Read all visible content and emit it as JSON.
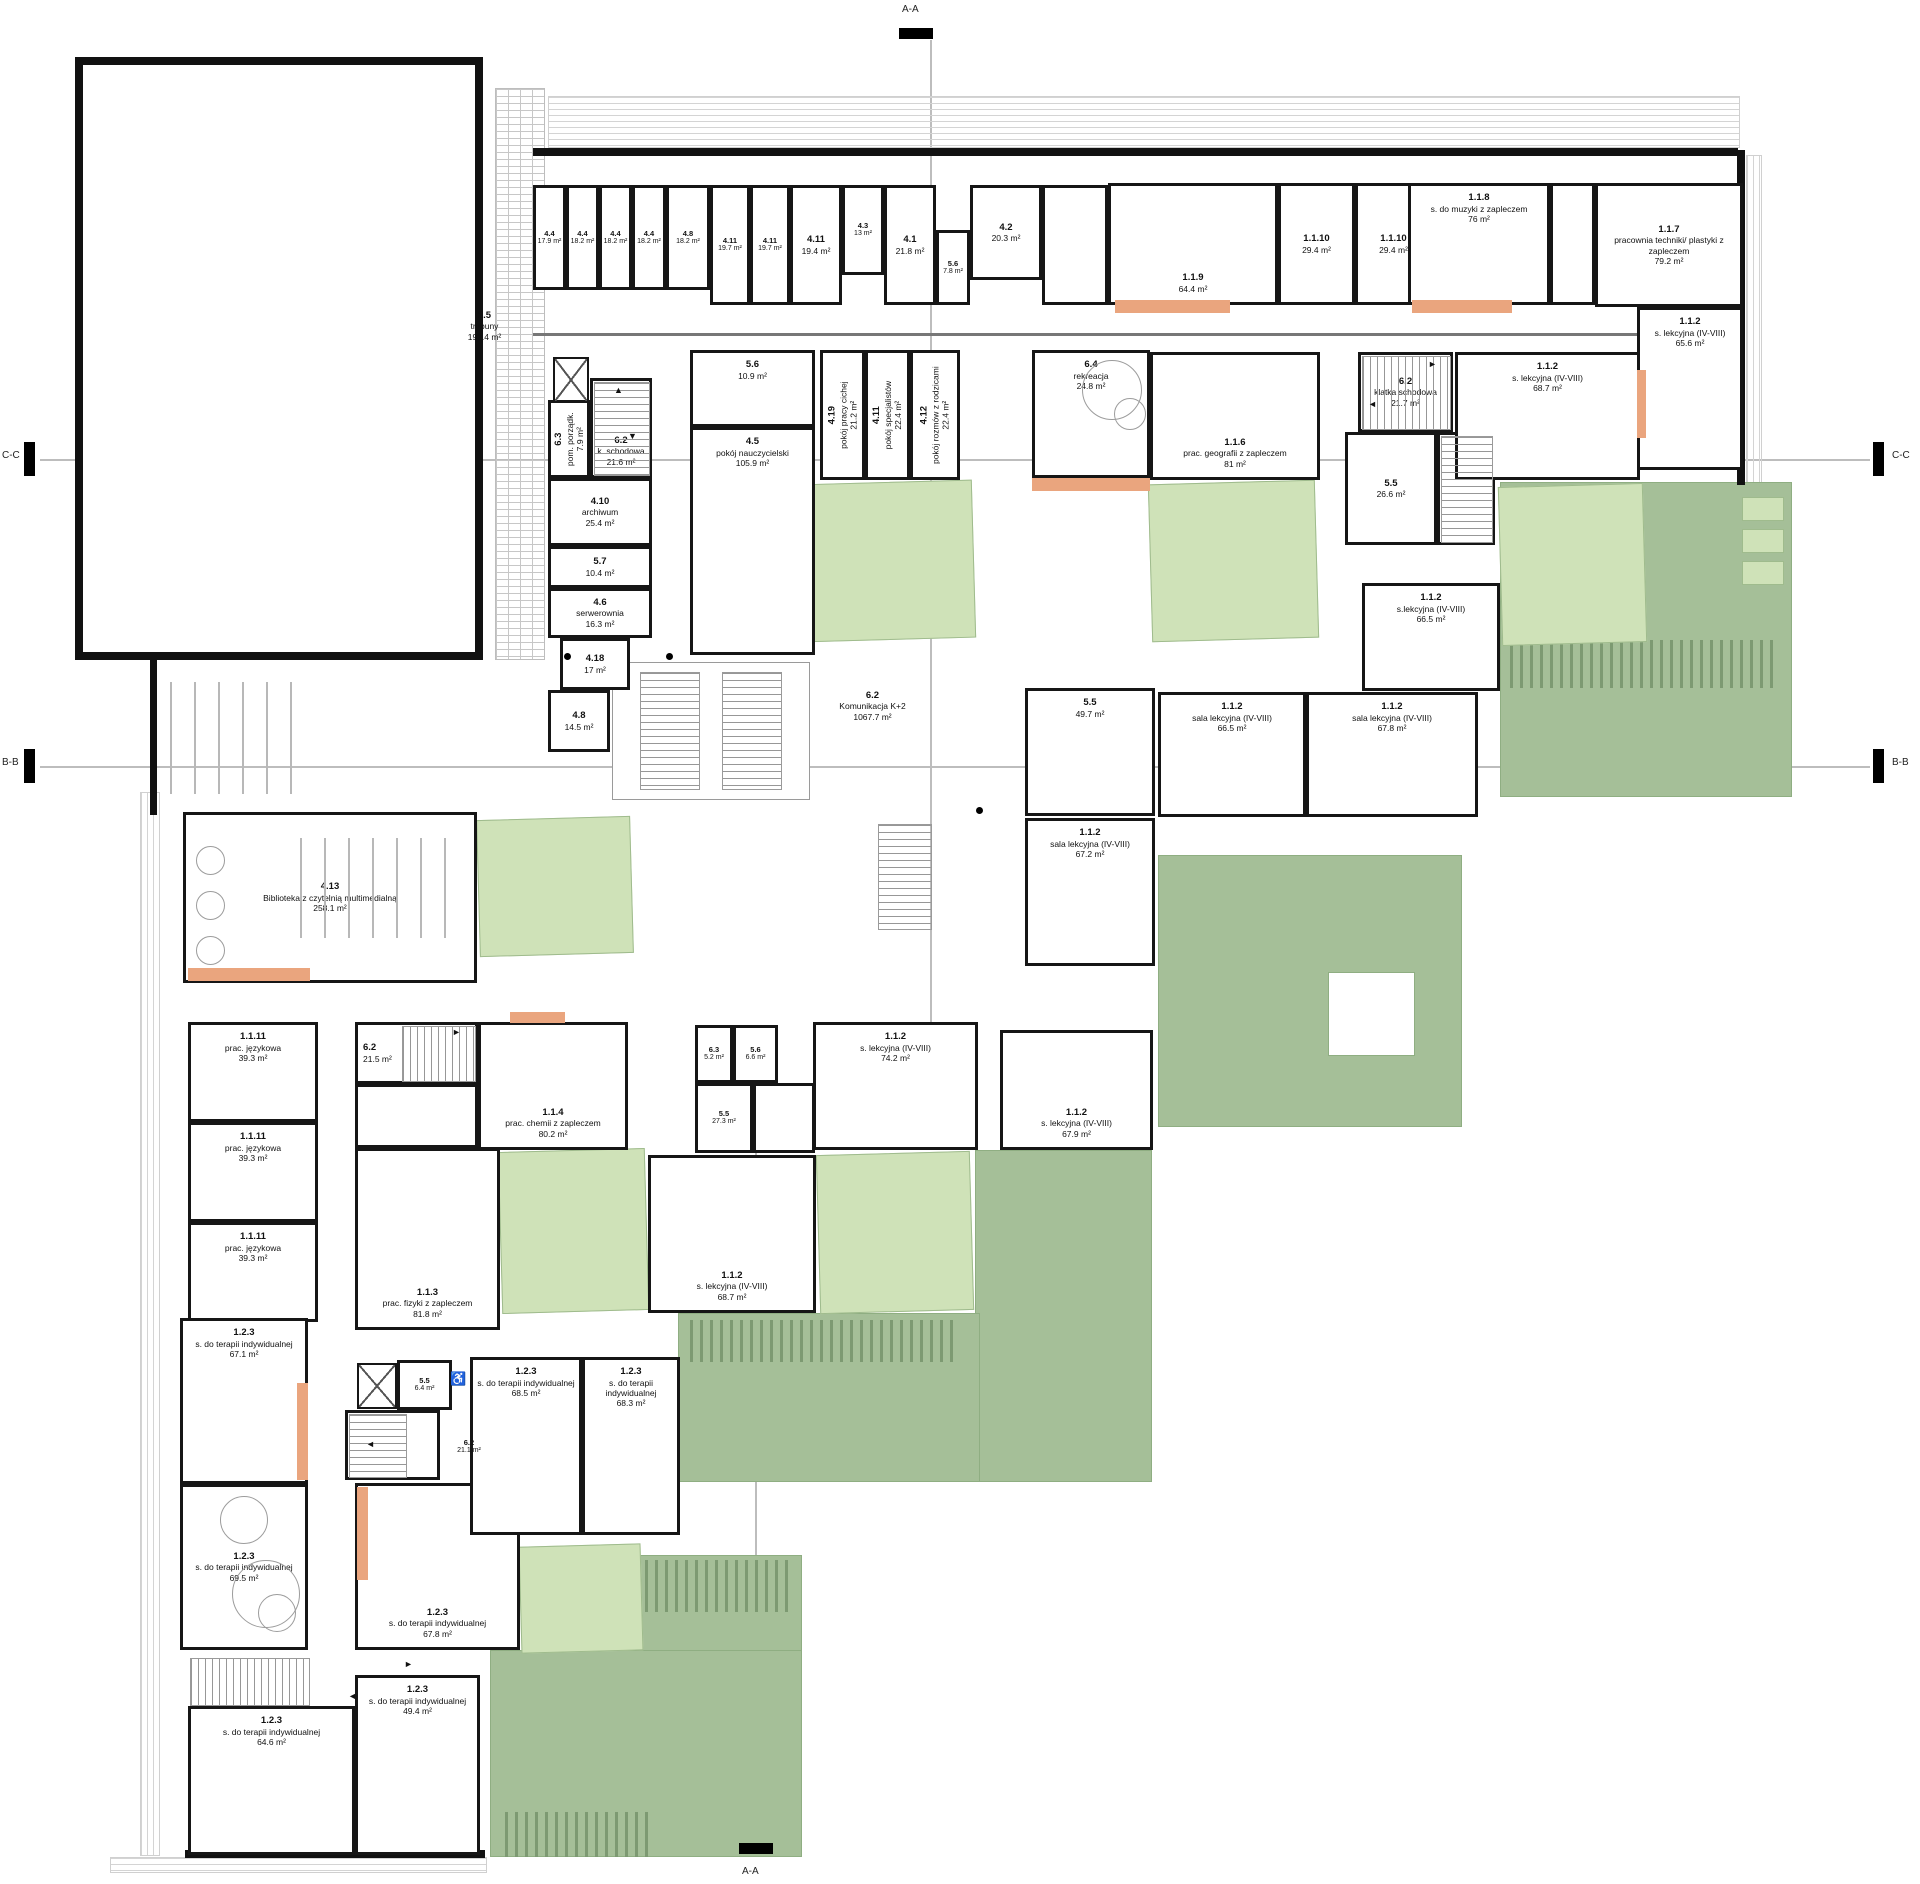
{
  "plan": {
    "width": 1920,
    "height": 1884,
    "colors": {
      "wall": "#161616",
      "patio_light": "#cfe2b8",
      "roof_green": "#a5bf98",
      "accent_orange": "#eaa57e",
      "section_line": "#bdbdbd"
    },
    "section_markers": {
      "top": "A-A",
      "bottom": "A-A",
      "left_c": "C-C",
      "left_b": "B-B",
      "right_c": "C-C",
      "right_b": "B-B"
    },
    "rooms": [
      {
        "id": "2.5",
        "name": "trybuny",
        "area": "192.4 m²",
        "x": 427,
        "y": 298,
        "w": 115,
        "h": 56,
        "nobox": 1
      },
      {
        "id": "4.4",
        "area": "17.9 m²",
        "x": 533,
        "y": 185,
        "w": 33,
        "h": 105,
        "sm": 1
      },
      {
        "id": "4.4",
        "area": "18.2 m²",
        "x": 566,
        "y": 185,
        "w": 33,
        "h": 105,
        "sm": 1
      },
      {
        "id": "4.4",
        "area": "18.2 m²",
        "x": 599,
        "y": 185,
        "w": 33,
        "h": 105,
        "sm": 1
      },
      {
        "id": "4.4",
        "area": "18.2 m²",
        "x": 632,
        "y": 185,
        "w": 34,
        "h": 105,
        "sm": 1
      },
      {
        "id": "4.8",
        "area": "18.2 m²",
        "x": 666,
        "y": 185,
        "w": 44,
        "h": 105,
        "sm": 1
      },
      {
        "id": "4.11",
        "area": "19.7 m²",
        "x": 710,
        "y": 185,
        "w": 40,
        "h": 120,
        "sm": 1
      },
      {
        "id": "4.11",
        "area": "19.7 m²",
        "x": 750,
        "y": 185,
        "w": 40,
        "h": 120,
        "sm": 1
      },
      {
        "id": "4.11",
        "area": "19.4 m²",
        "x": 790,
        "y": 185,
        "w": 52,
        "h": 120
      },
      {
        "id": "4.3",
        "area": "13 m²",
        "x": 842,
        "y": 185,
        "w": 42,
        "h": 90,
        "sm": 1
      },
      {
        "id": "4.1",
        "area": "21.8 m²",
        "x": 884,
        "y": 185,
        "w": 52,
        "h": 120
      },
      {
        "id": "5.6",
        "area": "7.8 m²",
        "x": 936,
        "y": 230,
        "w": 34,
        "h": 75,
        "sm": 1
      },
      {
        "id": "4.2",
        "area": "20.3 m²",
        "x": 970,
        "y": 185,
        "w": 72,
        "h": 95
      },
      {
        "x": 1042,
        "y": 185,
        "w": 66,
        "h": 120
      },
      {
        "id": "1.1.9",
        "area": "64.4 m²",
        "x": 1108,
        "y": 183,
        "w": 170,
        "h": 122,
        "lp": "b"
      },
      {
        "id": "1.1.10",
        "area": "29.4 m²",
        "x": 1278,
        "y": 183,
        "w": 77,
        "h": 122
      },
      {
        "id": "1.1.10",
        "area": "29.4 m²",
        "x": 1355,
        "y": 183,
        "w": 77,
        "h": 122
      },
      {
        "id": "1.1.8",
        "name": "s. do muzyki z zapleczem",
        "area": "76 m²",
        "x": 1408,
        "y": 183,
        "w": 142,
        "h": 122,
        "lp": "t"
      },
      {
        "x": 1550,
        "y": 183,
        "w": 45,
        "h": 122
      },
      {
        "id": "1.1.7",
        "name": "pracownia techniki/ plastyki z zapleczem",
        "area": "79.2 m²",
        "x": 1595,
        "y": 183,
        "w": 148,
        "h": 124
      },
      {
        "id": "1.1.2",
        "name": "s. lekcyjna (IV-VIII)",
        "area": "65.6 m²",
        "x": 1637,
        "y": 307,
        "w": 106,
        "h": 163,
        "lp": "t"
      },
      {
        "id": "6.3",
        "name": "pom. porządk.",
        "area": "7.9 m²",
        "x": 548,
        "y": 400,
        "w": 42,
        "h": 78,
        "v": 1
      },
      {
        "id": "6.2",
        "name": "k. schodowa",
        "area": "21.6 m²",
        "x": 590,
        "y": 378,
        "w": 62,
        "h": 100,
        "lp": "b"
      },
      {
        "id": "4.10",
        "name": "archiwum",
        "area": "25.4 m²",
        "x": 548,
        "y": 478,
        "w": 104,
        "h": 68
      },
      {
        "id": "5.7",
        "area": "10.4 m²",
        "x": 548,
        "y": 546,
        "w": 104,
        "h": 42
      },
      {
        "id": "4.6",
        "name": "serwerownia",
        "area": "16.3 m²",
        "x": 548,
        "y": 588,
        "w": 104,
        "h": 50
      },
      {
        "id": "4.18",
        "area": "17 m²",
        "x": 560,
        "y": 638,
        "w": 70,
        "h": 52
      },
      {
        "id": "4.8",
        "area": "14.5 m²",
        "x": 548,
        "y": 690,
        "w": 62,
        "h": 62
      },
      {
        "id": "5.6",
        "area": "10.9 m²",
        "x": 690,
        "y": 350,
        "w": 125,
        "h": 77,
        "lp": "t"
      },
      {
        "id": "4.5",
        "name": "pokój nauczycielski",
        "area": "105.9 m²",
        "x": 690,
        "y": 427,
        "w": 125,
        "h": 228,
        "lp": "t"
      },
      {
        "id": "4.19",
        "name": "pokój pracy cichej",
        "area": "21.2 m²",
        "x": 820,
        "y": 350,
        "w": 45,
        "h": 130,
        "v": 1
      },
      {
        "id": "4.11",
        "name": "pokój specjalistów",
        "area": "22.4 m²",
        "x": 865,
        "y": 350,
        "w": 45,
        "h": 130,
        "v": 1
      },
      {
        "id": "4.12",
        "name": "pokój rozmów z rodzicami",
        "area": "22.4 m²",
        "x": 910,
        "y": 350,
        "w": 50,
        "h": 130,
        "v": 1
      },
      {
        "id": "6.4",
        "name": "rekreacja",
        "area": "24.8 m²",
        "x": 1032,
        "y": 350,
        "w": 118,
        "h": 128,
        "lp": "t"
      },
      {
        "id": "1.1.6",
        "name": "prac. geografii z zapleczem",
        "area": "81 m²",
        "x": 1150,
        "y": 352,
        "w": 170,
        "h": 128,
        "lp": "b"
      },
      {
        "id": "6.2",
        "name": "klatka schodowa",
        "area": "21.7 m²",
        "x": 1358,
        "y": 352,
        "w": 95,
        "h": 80
      },
      {
        "id": "5.5",
        "area": "26.6 m²",
        "x": 1345,
        "y": 432,
        "w": 92,
        "h": 113
      },
      {
        "x": 1437,
        "y": 432,
        "w": 58,
        "h": 113
      },
      {
        "id": "1.1.2",
        "name": "s. lekcyjna (IV-VIII)",
        "area": "68.7 m²",
        "x": 1455,
        "y": 352,
        "w": 185,
        "h": 128,
        "lp": "t"
      },
      {
        "id": "5.5",
        "area": "49.7 m²",
        "x": 1025,
        "y": 688,
        "w": 130,
        "h": 128,
        "lp": "t"
      },
      {
        "id": "1.1.2",
        "name": "sala lekcyjna (IV-VIII)",
        "area": "66.5 m²",
        "x": 1158,
        "y": 692,
        "w": 148,
        "h": 125,
        "lp": "t"
      },
      {
        "id": "1.1.2",
        "name": "sala lekcyjna (IV-VIII)",
        "area": "67.8 m²",
        "x": 1306,
        "y": 692,
        "w": 172,
        "h": 125,
        "lp": "t"
      },
      {
        "id": "1.1.2",
        "name": "s.lekcyjna (IV-VIII)",
        "area": "66.5 m²",
        "x": 1362,
        "y": 583,
        "w": 138,
        "h": 108,
        "lp": "t"
      },
      {
        "id": "1.1.2",
        "name": "sala lekcyjna (IV-VIII)",
        "area": "67.2 m²",
        "x": 1025,
        "y": 818,
        "w": 130,
        "h": 148,
        "lp": "t"
      },
      {
        "id": "4.13",
        "name": "Biblioteka z czytelnią multimedialną",
        "area": "258.1 m²",
        "x": 183,
        "y": 812,
        "w": 294,
        "h": 171
      },
      {
        "id": "6.2",
        "name": "Komunikacja K+2",
        "area": "1067.7 m²",
        "x": 800,
        "y": 676,
        "w": 145,
        "h": 60,
        "nobox": 1
      },
      {
        "id": "1.1.11",
        "name": "prac. językowa",
        "area": "39.3 m²",
        "x": 188,
        "y": 1022,
        "w": 130,
        "h": 100,
        "lp": "t"
      },
      {
        "id": "1.1.11",
        "name": "prac. językowa",
        "area": "39.3 m²",
        "x": 188,
        "y": 1122,
        "w": 130,
        "h": 100,
        "lp": "t"
      },
      {
        "id": "1.1.11",
        "name": "prac. językowa",
        "area": "39.3 m²",
        "x": 188,
        "y": 1222,
        "w": 130,
        "h": 100,
        "lp": "t"
      },
      {
        "id": "6.2",
        "area": "21.5 m²",
        "x": 355,
        "y": 1022,
        "w": 123,
        "h": 62,
        "lp": "l"
      },
      {
        "id": "1.1.4",
        "name": "prac. chemii z zapleczem",
        "area": "80.2 m²",
        "x": 478,
        "y": 1022,
        "w": 150,
        "h": 128,
        "lp": "b"
      },
      {
        "x": 355,
        "y": 1084,
        "w": 123,
        "h": 64
      },
      {
        "id": "1.1.3",
        "name": "prac. fizyki z zapleczem",
        "area": "81.8 m²",
        "x": 355,
        "y": 1148,
        "w": 145,
        "h": 182,
        "lp": "b"
      },
      {
        "id": "1.1.2",
        "name": "s. lekcyjna (IV-VIII)",
        "area": "74.2 m²",
        "x": 813,
        "y": 1022,
        "w": 165,
        "h": 128,
        "lp": "t"
      },
      {
        "id": "6.3",
        "area": "5.2 m²",
        "x": 695,
        "y": 1025,
        "w": 38,
        "h": 58,
        "sm": 1
      },
      {
        "id": "5.6",
        "area": "6.6 m²",
        "x": 733,
        "y": 1025,
        "w": 45,
        "h": 58,
        "sm": 1
      },
      {
        "id": "5.5",
        "area": "27.3 m²",
        "x": 695,
        "y": 1083,
        "w": 58,
        "h": 70,
        "sm": 1
      },
      {
        "x": 753,
        "y": 1083,
        "w": 62,
        "h": 70
      },
      {
        "id": "1.1.2",
        "name": "s. lekcyjna (IV-VIII)",
        "area": "68.7 m²",
        "x": 648,
        "y": 1155,
        "w": 168,
        "h": 158,
        "lp": "b"
      },
      {
        "id": "1.1.2",
        "name": "s. lekcyjna (IV-VIII)",
        "area": "67.9 m²",
        "x": 1000,
        "y": 1030,
        "w": 153,
        "h": 120,
        "lp": "b"
      },
      {
        "id": "1.2.3",
        "name": "s. do terapii indywidualnej",
        "area": "67.1 m²",
        "x": 180,
        "y": 1318,
        "w": 128,
        "h": 166,
        "lp": "t"
      },
      {
        "id": "1.2.3",
        "name": "s. do terapii indywidualnej",
        "area": "69.5 m²",
        "x": 180,
        "y": 1484,
        "w": 128,
        "h": 166
      },
      {
        "id": "1.2.3",
        "name": "s. do terapii indywidualnej",
        "area": "67.8 m²",
        "x": 355,
        "y": 1483,
        "w": 165,
        "h": 167,
        "lp": "b"
      },
      {
        "id": "1.2.3",
        "name": "s. do terapii indywidualnej",
        "area": "68.5 m²",
        "x": 470,
        "y": 1357,
        "w": 112,
        "h": 178,
        "lp": "t"
      },
      {
        "id": "1.2.3",
        "name": "s. do terapii indywidualnej",
        "area": "68.3 m²",
        "x": 582,
        "y": 1357,
        "w": 98,
        "h": 178,
        "lp": "t"
      },
      {
        "id": "5.5",
        "area": "6.4 m²",
        "x": 397,
        "y": 1360,
        "w": 55,
        "h": 50,
        "sm": 1
      },
      {
        "x": 345,
        "y": 1410,
        "w": 95,
        "h": 70
      },
      {
        "id": "6.2",
        "area": "21.1 m²",
        "x": 440,
        "y": 1424,
        "w": 58,
        "h": 46,
        "nobox": 1,
        "sm": 1
      },
      {
        "id": "1.2.3",
        "name": "s. do terapii indywidualnej",
        "area": "64.6 m²",
        "x": 188,
        "y": 1706,
        "w": 167,
        "h": 149,
        "lp": "t"
      },
      {
        "id": "1.2.3",
        "name": "s. do terapii indywidualnej",
        "area": "49.4 m²",
        "x": 355,
        "y": 1675,
        "w": 125,
        "h": 180,
        "lp": "t"
      }
    ],
    "greens": [
      {
        "x": 1500,
        "y": 482,
        "w": 290,
        "h": 313
      },
      {
        "x": 1158,
        "y": 855,
        "w": 302,
        "h": 270
      },
      {
        "x": 975,
        "y": 1150,
        "w": 175,
        "h": 330
      },
      {
        "x": 678,
        "y": 1313,
        "w": 300,
        "h": 167
      },
      {
        "x": 640,
        "y": 1555,
        "w": 160,
        "h": 95
      },
      {
        "x": 490,
        "y": 1650,
        "w": 310,
        "h": 205
      }
    ],
    "holes": [
      {
        "x": 1328,
        "y": 972,
        "w": 85,
        "h": 82
      }
    ],
    "patios": [
      {
        "x": 800,
        "y": 482,
        "w": 172,
        "h": 156
      },
      {
        "x": 1150,
        "y": 482,
        "w": 165,
        "h": 156
      },
      {
        "x": 1500,
        "y": 485,
        "w": 143,
        "h": 157
      },
      {
        "x": 478,
        "y": 818,
        "w": 152,
        "h": 135
      },
      {
        "x": 500,
        "y": 1150,
        "w": 145,
        "h": 160
      },
      {
        "x": 818,
        "y": 1153,
        "w": 152,
        "h": 157
      },
      {
        "x": 520,
        "y": 1545,
        "w": 120,
        "h": 105
      },
      {
        "x": 1742,
        "y": 497,
        "w": 40,
        "h": 22,
        "r0": 1
      },
      {
        "x": 1742,
        "y": 529,
        "w": 40,
        "h": 22,
        "r0": 1
      },
      {
        "x": 1742,
        "y": 561,
        "w": 40,
        "h": 22,
        "r0": 1
      }
    ],
    "combs": [
      {
        "x": 1510,
        "y": 640,
        "w": 265,
        "h": 48
      },
      {
        "x": 690,
        "y": 1320,
        "w": 268,
        "h": 42
      },
      {
        "x": 645,
        "y": 1560,
        "w": 150,
        "h": 52
      },
      {
        "x": 505,
        "y": 1812,
        "w": 150,
        "h": 45
      }
    ],
    "accents": [
      {
        "x": 1115,
        "y": 300,
        "w": 115,
        "h": 13
      },
      {
        "x": 1412,
        "y": 300,
        "w": 100,
        "h": 13
      },
      {
        "x": 1032,
        "y": 478,
        "w": 118,
        "h": 13
      },
      {
        "x": 1637,
        "y": 370,
        "w": 9,
        "h": 68
      },
      {
        "x": 188,
        "y": 968,
        "w": 122,
        "h": 13
      },
      {
        "x": 510,
        "y": 1012,
        "w": 55,
        "h": 11
      },
      {
        "x": 297,
        "y": 1383,
        "w": 11,
        "h": 97
      },
      {
        "x": 357,
        "y": 1487,
        "w": 11,
        "h": 93
      }
    ],
    "facades": [
      {
        "x": 548,
        "y": 96,
        "w": 1190,
        "h": 50,
        "dir": "h"
      },
      {
        "x": 1746,
        "y": 155,
        "w": 14,
        "h": 440,
        "dir": "v"
      },
      {
        "x": 140,
        "y": 792,
        "w": 18,
        "h": 1062,
        "dir": "v"
      },
      {
        "x": 110,
        "y": 1857,
        "w": 375,
        "h": 14,
        "dir": "h"
      }
    ],
    "trybuny_strip": {
      "x": 495,
      "y": 88,
      "w": 48,
      "h": 570
    },
    "walls": [
      {
        "x": 533,
        "y": 148,
        "w": 1205,
        "h": 8
      },
      {
        "x": 1737,
        "y": 150,
        "w": 8,
        "h": 335
      },
      {
        "x": 150,
        "y": 660,
        "w": 7,
        "h": 155
      },
      {
        "x": 185,
        "y": 1850,
        "w": 300,
        "h": 8
      }
    ],
    "thin_lines": [
      {
        "x": 533,
        "y": 333,
        "w": 1205,
        "h": 2.5
      }
    ],
    "stairs": [
      {
        "x": 594,
        "y": 382,
        "w": 54,
        "h": 92,
        "dir": "v"
      },
      {
        "x": 1362,
        "y": 356,
        "w": 87,
        "h": 72,
        "dir": "h"
      },
      {
        "x": 402,
        "y": 1026,
        "w": 72,
        "h": 54,
        "dir": "h"
      },
      {
        "x": 640,
        "y": 672,
        "w": 58,
        "h": 116,
        "dir": "v"
      },
      {
        "x": 722,
        "y": 672,
        "w": 58,
        "h": 116,
        "dir": "v"
      },
      {
        "x": 349,
        "y": 1414,
        "w": 56,
        "h": 62,
        "dir": "v"
      },
      {
        "x": 190,
        "y": 1658,
        "w": 118,
        "h": 46,
        "dir": "h"
      },
      {
        "x": 1441,
        "y": 436,
        "w": 50,
        "h": 105,
        "dir": "v"
      },
      {
        "x": 878,
        "y": 824,
        "w": 52,
        "h": 104,
        "dir": "v"
      }
    ],
    "frames": [
      {
        "x": 612,
        "y": 662,
        "w": 196,
        "h": 136
      }
    ],
    "elevators": [
      {
        "x": 553,
        "y": 357,
        "w": 36,
        "h": 46
      },
      {
        "x": 357,
        "y": 1363,
        "w": 40,
        "h": 46
      }
    ],
    "shelves": [
      {
        "x": 300,
        "y": 838,
        "w": 160,
        "h": 100
      },
      {
        "x": 170,
        "y": 682,
        "w": 135,
        "h": 112
      }
    ],
    "circles": [
      {
        "x": 1082,
        "y": 360,
        "d": 58
      },
      {
        "x": 1114,
        "y": 398,
        "d": 30
      },
      {
        "x": 196,
        "y": 846,
        "d": 27
      },
      {
        "x": 196,
        "y": 891,
        "d": 27
      },
      {
        "x": 196,
        "y": 936,
        "d": 27
      },
      {
        "x": 232,
        "y": 1560,
        "d": 66
      },
      {
        "x": 258,
        "y": 1594,
        "d": 36
      },
      {
        "x": 220,
        "y": 1496,
        "d": 46
      }
    ],
    "dots": [
      {
        "x": 564,
        "y": 653
      },
      {
        "x": 666,
        "y": 653
      },
      {
        "x": 976,
        "y": 807
      }
    ],
    "arrows": [
      {
        "ch": "▲",
        "x": 614,
        "y": 386
      },
      {
        "ch": "▼",
        "x": 628,
        "y": 432
      },
      {
        "ch": "►",
        "x": 1428,
        "y": 360
      },
      {
        "ch": "◄",
        "x": 1368,
        "y": 400
      },
      {
        "ch": "►",
        "x": 452,
        "y": 1028
      },
      {
        "ch": "◄",
        "x": 366,
        "y": 1440
      },
      {
        "ch": "►",
        "x": 404,
        "y": 1660
      },
      {
        "ch": "◄",
        "x": 348,
        "y": 1692
      }
    ],
    "wheelchairs": [
      {
        "x": 450,
        "y": 1372
      }
    ],
    "section_lines": [
      {
        "x": 930,
        "y": 40,
        "w": 1.5,
        "h": 1090
      },
      {
        "x": 755,
        "y": 1130,
        "w": 1.5,
        "h": 713
      },
      {
        "x": 40,
        "y": 459,
        "w": 1830,
        "h": 1.5
      },
      {
        "x": 40,
        "y": 766,
        "w": 1830,
        "h": 1.5
      }
    ],
    "ticks": [
      {
        "x": 899,
        "y": 28,
        "w": 34,
        "h": 11
      },
      {
        "x": 739,
        "y": 1843,
        "w": 34,
        "h": 11
      },
      {
        "x": 24,
        "y": 442,
        "w": 11,
        "h": 34
      },
      {
        "x": 24,
        "y": 749,
        "w": 11,
        "h": 34
      },
      {
        "x": 1873,
        "y": 442,
        "w": 11,
        "h": 34
      },
      {
        "x": 1873,
        "y": 749,
        "w": 11,
        "h": 34
      }
    ]
  }
}
